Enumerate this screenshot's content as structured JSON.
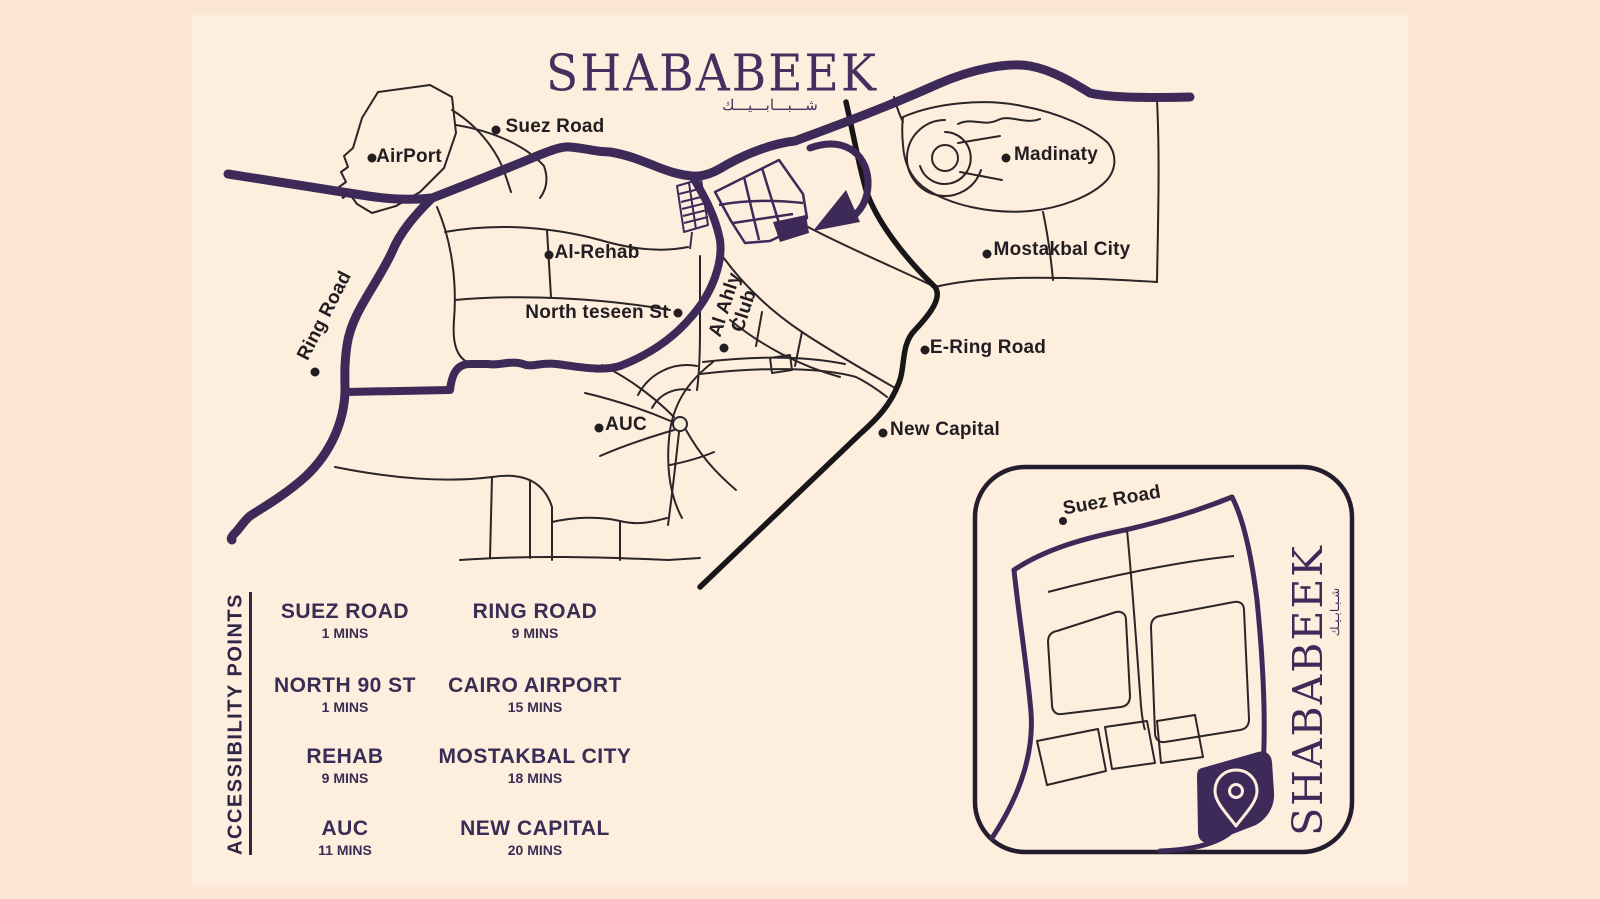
{
  "title": {
    "main": "SHABABEEK",
    "arabic": "شـــبـــابـــيـــك"
  },
  "map": {
    "labels": [
      {
        "text": "Suez Road"
      },
      {
        "text": "AirPort"
      },
      {
        "text": "Al-Rehab"
      },
      {
        "text": "Ring Road"
      },
      {
        "text": "North teseen St"
      },
      {
        "text": "Al Ahly Club"
      },
      {
        "text": "AUC"
      },
      {
        "text": "Madinaty"
      },
      {
        "text": "Mostakbal City"
      },
      {
        "text": "E-Ring Road"
      },
      {
        "text": "New Capital"
      }
    ],
    "icons": [
      "location-dot",
      "roundabout-circle",
      "direction-arrow"
    ]
  },
  "inset": {
    "suez_road_label": "Suez Road",
    "brand_vertical": "SHABABEEK",
    "brand_vertical_arabic": "شـبـابـيـك",
    "pin_icon": "location-pin"
  },
  "legend": {
    "heading": "ACCESSIBILITY POINTS",
    "items": [
      {
        "name": "SUEZ ROAD",
        "time": "1 MINS"
      },
      {
        "name": "RING ROAD",
        "time": "9 MINS"
      },
      {
        "name": "NORTH 90 ST",
        "time": "1 MINS"
      },
      {
        "name": "CAIRO AIRPORT",
        "time": "15 MINS"
      },
      {
        "name": "REHAB",
        "time": "9 MINS"
      },
      {
        "name": "MOSTAKBAL CITY",
        "time": "18 MINS"
      },
      {
        "name": "AUC",
        "time": "11 MINS"
      },
      {
        "name": "NEW CAPITAL",
        "time": "20 MINS"
      }
    ]
  },
  "colors": {
    "background_outer": "#fbe7d3",
    "background_inner": "#fdeedd",
    "road_purple": "#3e2a58",
    "road_black": "#19161a",
    "road_thin": "#2b2528",
    "label_text": "#221d21",
    "legend_text": "#3a2d55",
    "brand_purple": "#44305f"
  }
}
